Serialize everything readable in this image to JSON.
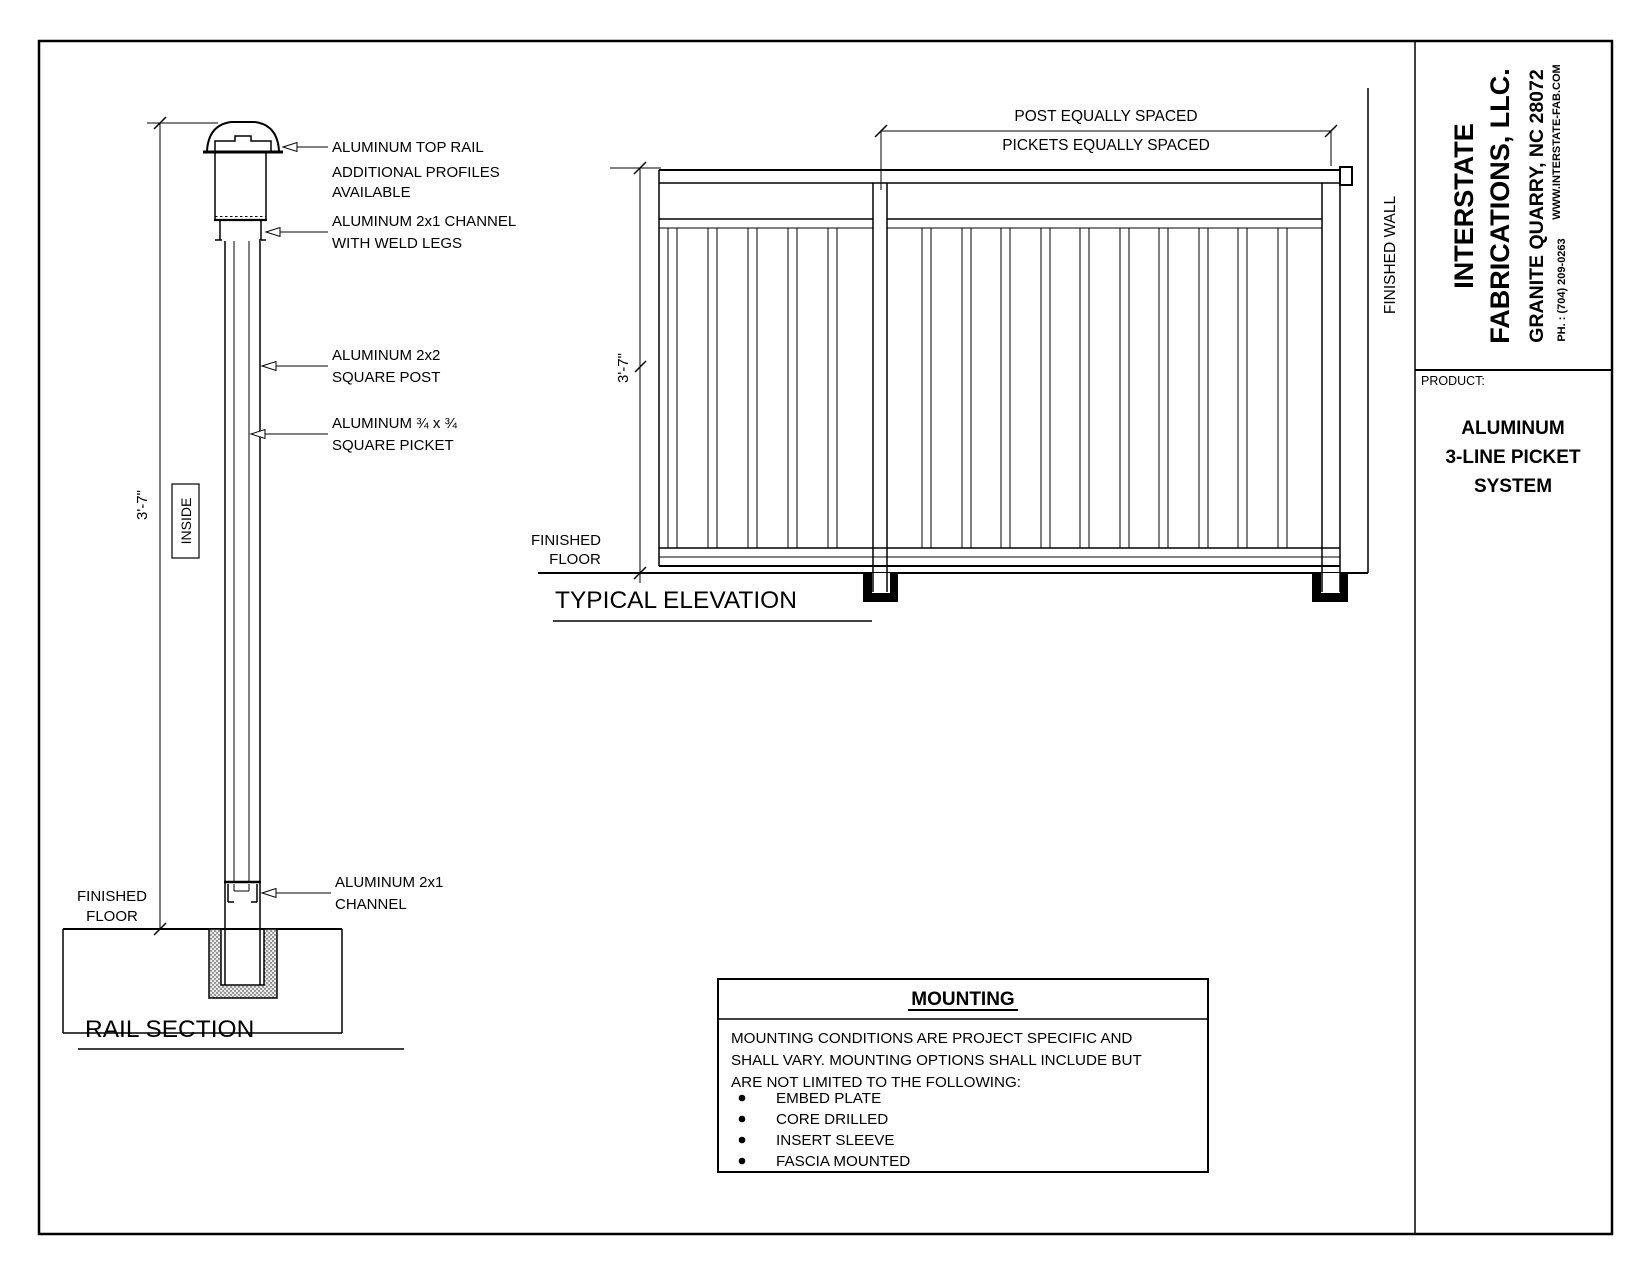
{
  "title_block": {
    "company_line1": "INTERSTATE",
    "company_line2": "FABRICATIONS, LLC.",
    "address": "GRANITE QUARRY, NC 28072",
    "website": "WWW.INTERSTATE-FAB.COM",
    "phone": "PH. : (704) 209-0263",
    "product_label": "PRODUCT:",
    "product_name_line1": "ALUMINUM",
    "product_name_line2": "3-LINE PICKET",
    "product_name_line3": "SYSTEM"
  },
  "rail_section": {
    "title": "RAIL SECTION",
    "dim_height": "3'-7\"",
    "inside_label": "INSIDE",
    "finished_floor_line1": "FINISHED",
    "finished_floor_line2": "FLOOR",
    "labels": {
      "top_rail": "ALUMINUM TOP RAIL",
      "profiles_line1": "ADDITIONAL  PROFILES",
      "profiles_line2": "AVAILABLE",
      "channel_weld_line1": "ALUMINUM 2x1 CHANNEL",
      "channel_weld_line2": "WITH WELD LEGS",
      "post_line1": "ALUMINUM 2x2",
      "post_line2": "SQUARE POST",
      "picket_line1": "ALUMINUM ¾ x ¾",
      "picket_line2": "SQUARE PICKET",
      "bottom_channel_line1": "ALUMINUM 2x1",
      "bottom_channel_line2": "CHANNEL"
    }
  },
  "elevation": {
    "title": "TYPICAL ELEVATION",
    "dim_post": "POST EQUALLY SPACED",
    "dim_pickets": "PICKETS EQUALLY SPACED",
    "dim_height": "3'-7\"",
    "finished_wall": "FINISHED WALL",
    "finished_floor_line1": "FINISHED",
    "finished_floor_line2": "FLOOR"
  },
  "mounting": {
    "title": "MOUNTING",
    "body_line1": "MOUNTING CONDITIONS ARE PROJECT SPECIFIC AND",
    "body_line2": "SHALL VARY. MOUNTING OPTIONS SHALL INCLUDE BUT",
    "body_line3": "ARE NOT LIMITED TO THE FOLLOWING:",
    "bullets": [
      "EMBED PLATE",
      "CORE DRILLED",
      "INSERT SLEEVE",
      "FASCIA MOUNTED"
    ]
  }
}
